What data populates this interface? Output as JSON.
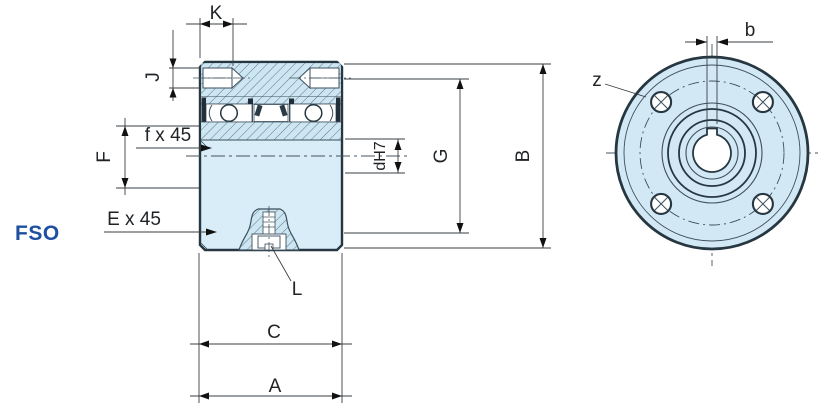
{
  "product_code": "FSO",
  "colors": {
    "body_fill": "#d8edf8",
    "section_fill": "#cde6f2",
    "front_fill": "#d2e9f5",
    "outline": "#263741",
    "thin_line": "#3c4f5c",
    "hatch_line": "#5b7889",
    "seal_dark": "#222e38",
    "dimension_line": "#3a3f44",
    "accent": "#1e4fa1",
    "background": "#ffffff"
  },
  "labels": {
    "K": "K",
    "J": "J",
    "F": "F",
    "f_chamfer": "f x 45",
    "E_chamfer": "E x 45",
    "L": "L",
    "C": "C",
    "A": "A",
    "d_bore": "dH7",
    "G": "G",
    "B": "B",
    "b": "b",
    "z": "z"
  },
  "front_view": {
    "bolt_hole_count": 4
  }
}
